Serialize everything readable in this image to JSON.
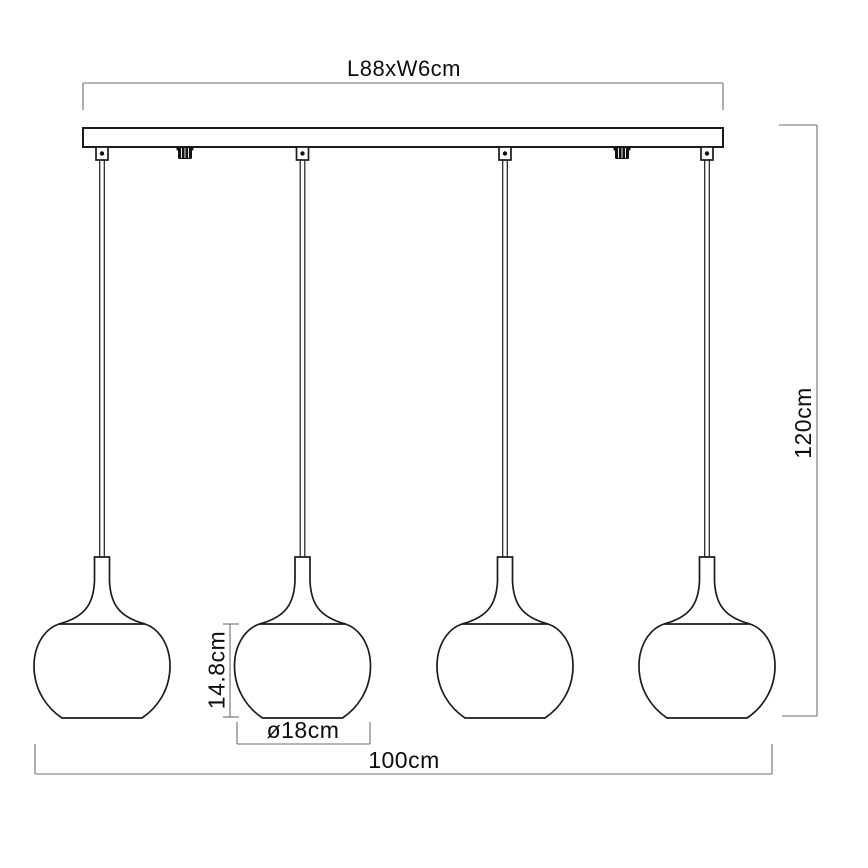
{
  "diagram": {
    "type": "technical-dimension-drawing",
    "subject": "4-light linear pendant lamp",
    "pendant_count": 4,
    "labels": {
      "canopy_size": "L88xW6cm",
      "overall_height": "120cm",
      "shade_height": "14.8cm",
      "shade_diameter": "ø18cm",
      "overall_width": "100cm"
    },
    "colors": {
      "background": "#ffffff",
      "object_line": "#1b1b1b",
      "dimension_line": "#6f6f6f",
      "label_text": "#0d0d0d"
    }
  }
}
